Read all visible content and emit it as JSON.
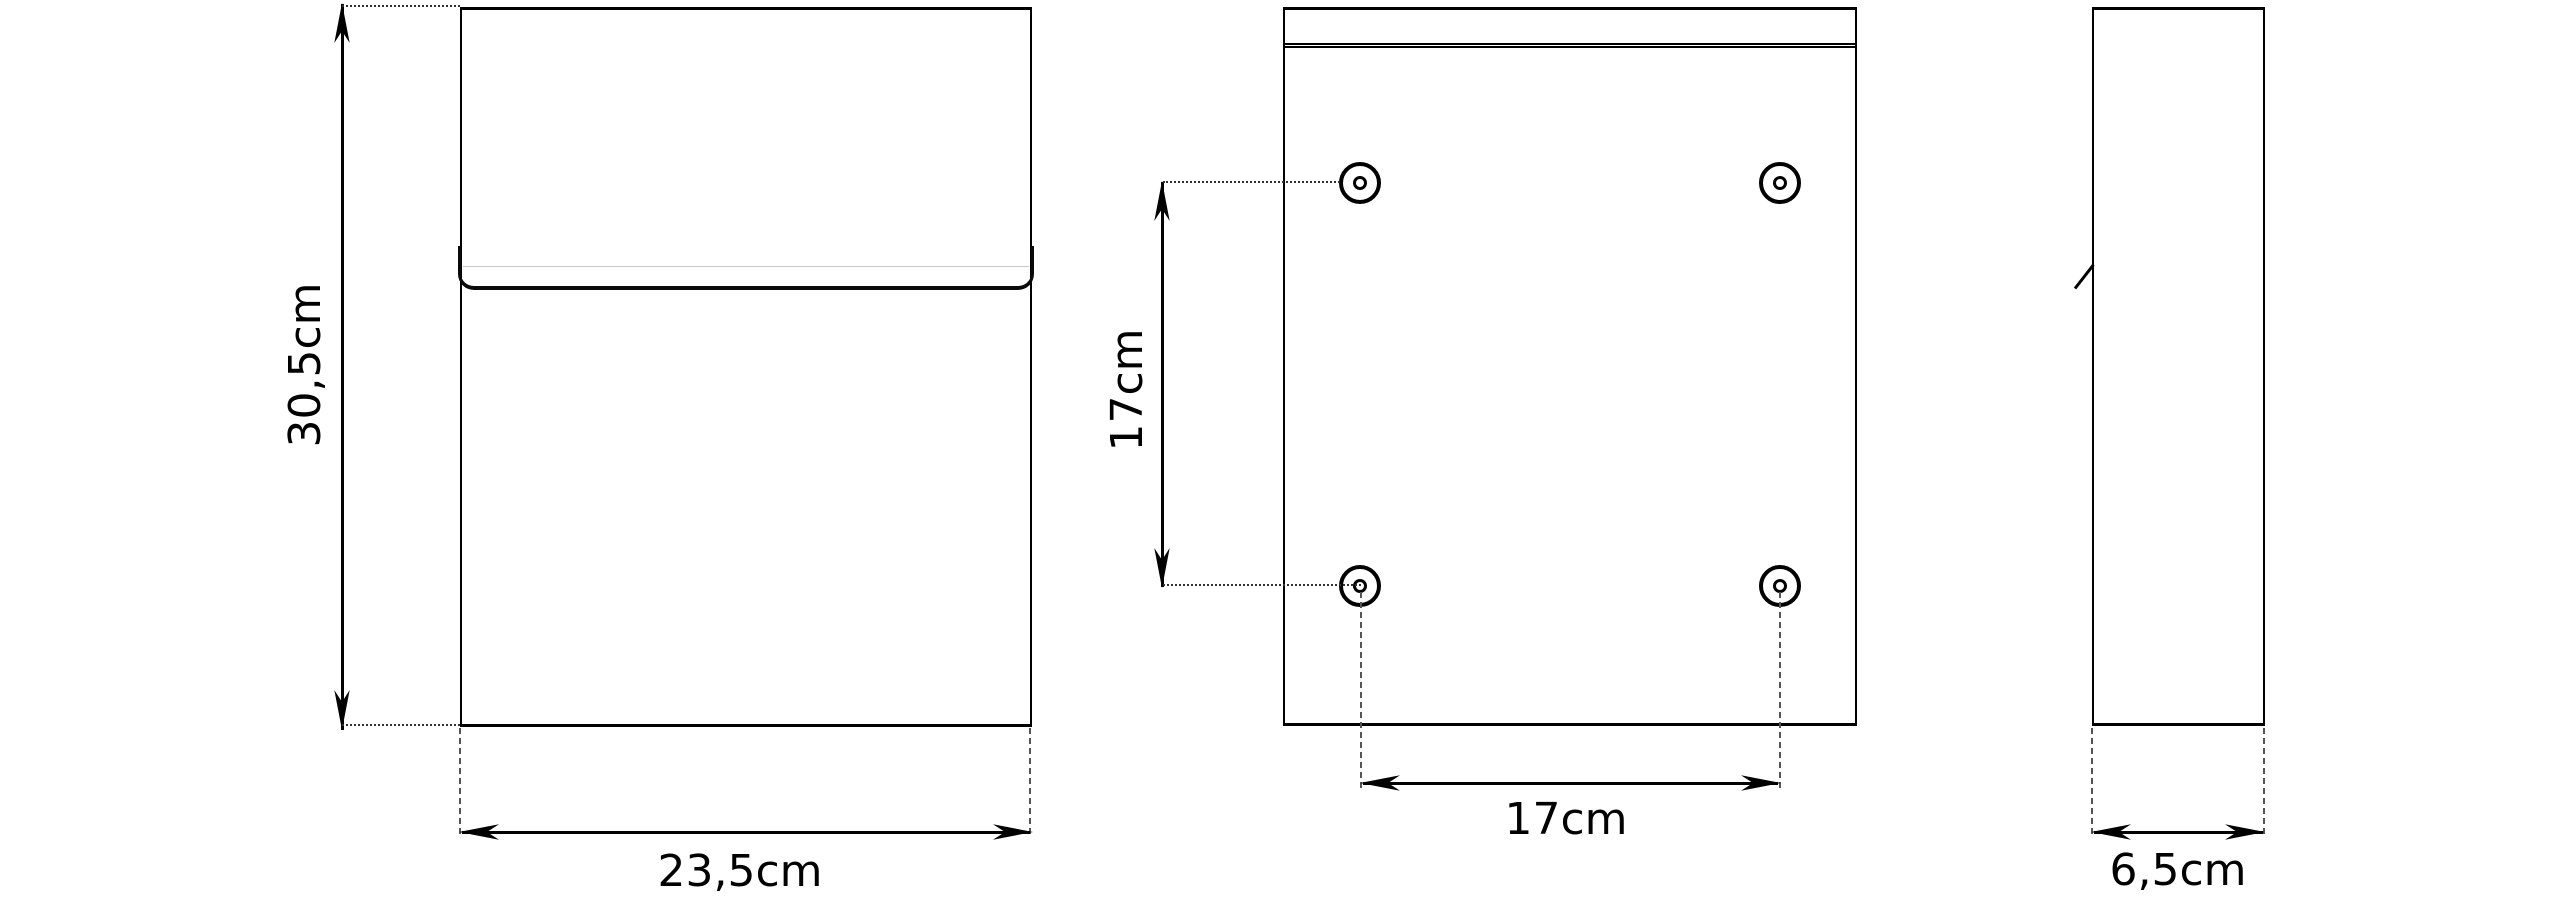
{
  "diagram": {
    "front_view": {
      "height_label": "30,5cm",
      "width_label": "23,5cm"
    },
    "back_view": {
      "vertical_spacing_label": "17cm",
      "horizontal_spacing_label": "17cm"
    },
    "side_view": {
      "depth_label": "6,5cm"
    }
  },
  "colors": {
    "line": "#000000",
    "dashed_line": "#555555",
    "flap_seam": "#c8c8c8",
    "background": "#ffffff"
  }
}
